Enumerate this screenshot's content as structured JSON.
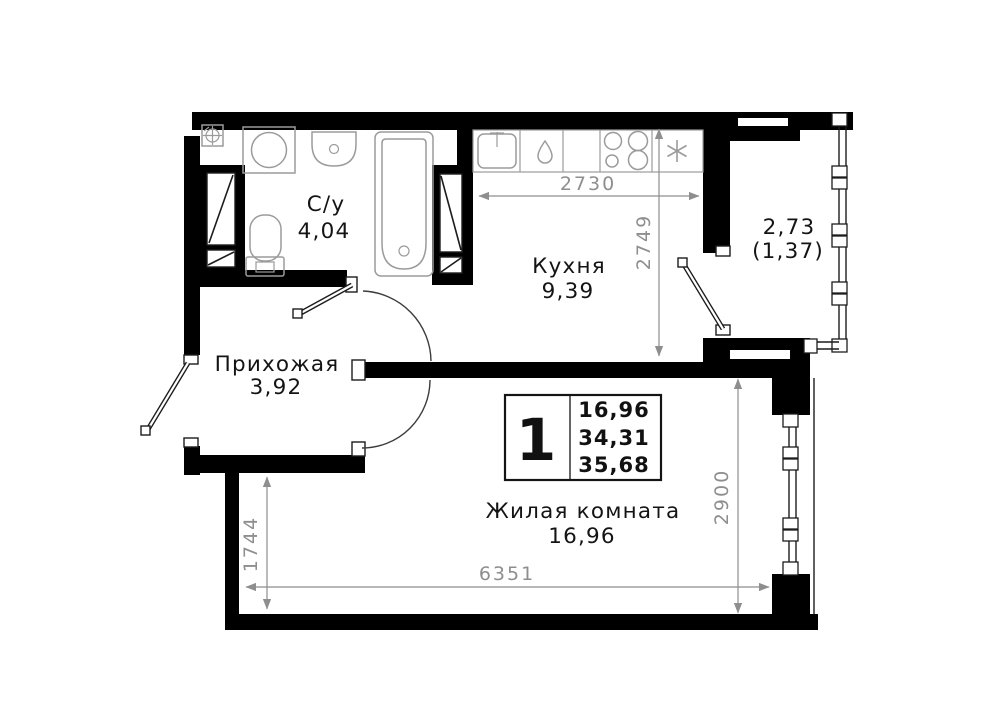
{
  "plan": {
    "rooms": {
      "bathroom": {
        "name": "С/у",
        "area": "4,04"
      },
      "kitchen": {
        "name": "Кухня",
        "area": "9,39"
      },
      "hallway": {
        "name": "Прихожая",
        "area": "3,92"
      },
      "living": {
        "name": "Жилая комната",
        "area": "16,96"
      },
      "balcony": {
        "area_full": "2,73",
        "area_counted": "(1,37)"
      }
    },
    "info_box": {
      "room_count": "1",
      "living_area": "16,96",
      "area_no_balcony": "34,31",
      "total_area": "35,68"
    },
    "dimensions": {
      "kitchen_width": "2730",
      "kitchen_depth": "2749",
      "living_depth": "2900",
      "living_width": "6351",
      "hall_depth": "1744"
    },
    "colors": {
      "wall": "#000000",
      "dimension": "#8e8e8e",
      "text": "#141414",
      "background": "#ffffff"
    }
  }
}
